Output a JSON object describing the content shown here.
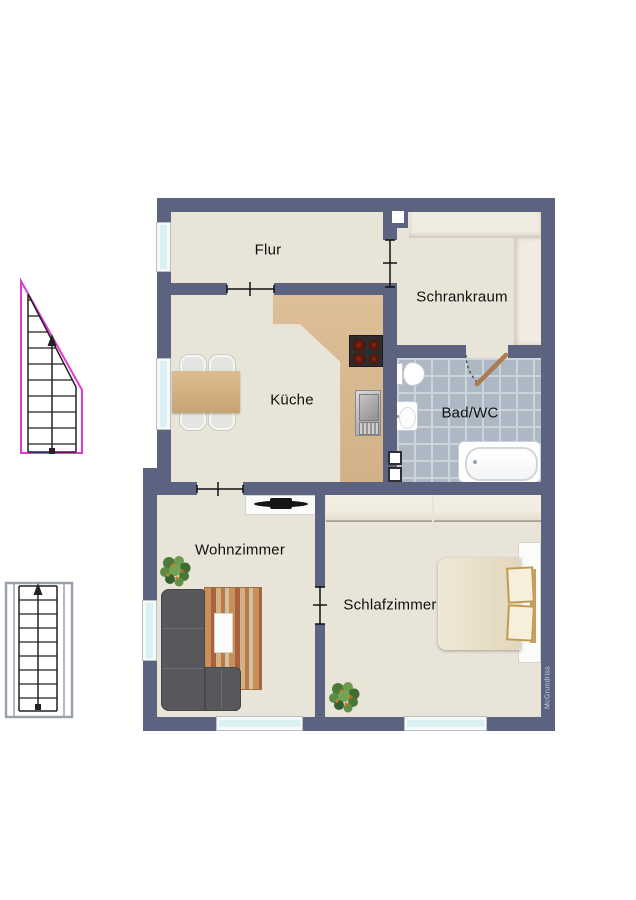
{
  "watermark": "McGrundriss",
  "rooms": [
    {
      "id": "flur",
      "label": "Flur"
    },
    {
      "id": "schrankraum",
      "label": "Schrankraum"
    },
    {
      "id": "kueche",
      "label": "Küche"
    },
    {
      "id": "bad_wc",
      "label": "Bad/WC"
    },
    {
      "id": "wohnzimmer",
      "label": "Wohnzimmer"
    },
    {
      "id": "schlafzimmer",
      "label": "Schlafzimmer"
    }
  ],
  "colors": {
    "wall": "#5b6380",
    "floor": "#e8e4d8",
    "bath_tile": "#aeb7c4",
    "kitchen_counter": "#d8b992",
    "window_glass": "#d9f1f4",
    "door_leaf": "#a97c52",
    "upper_stairs_outline": "#e23ad2",
    "lower_stairs_outline": "#9ba1ab",
    "sofa": "#57585c"
  }
}
